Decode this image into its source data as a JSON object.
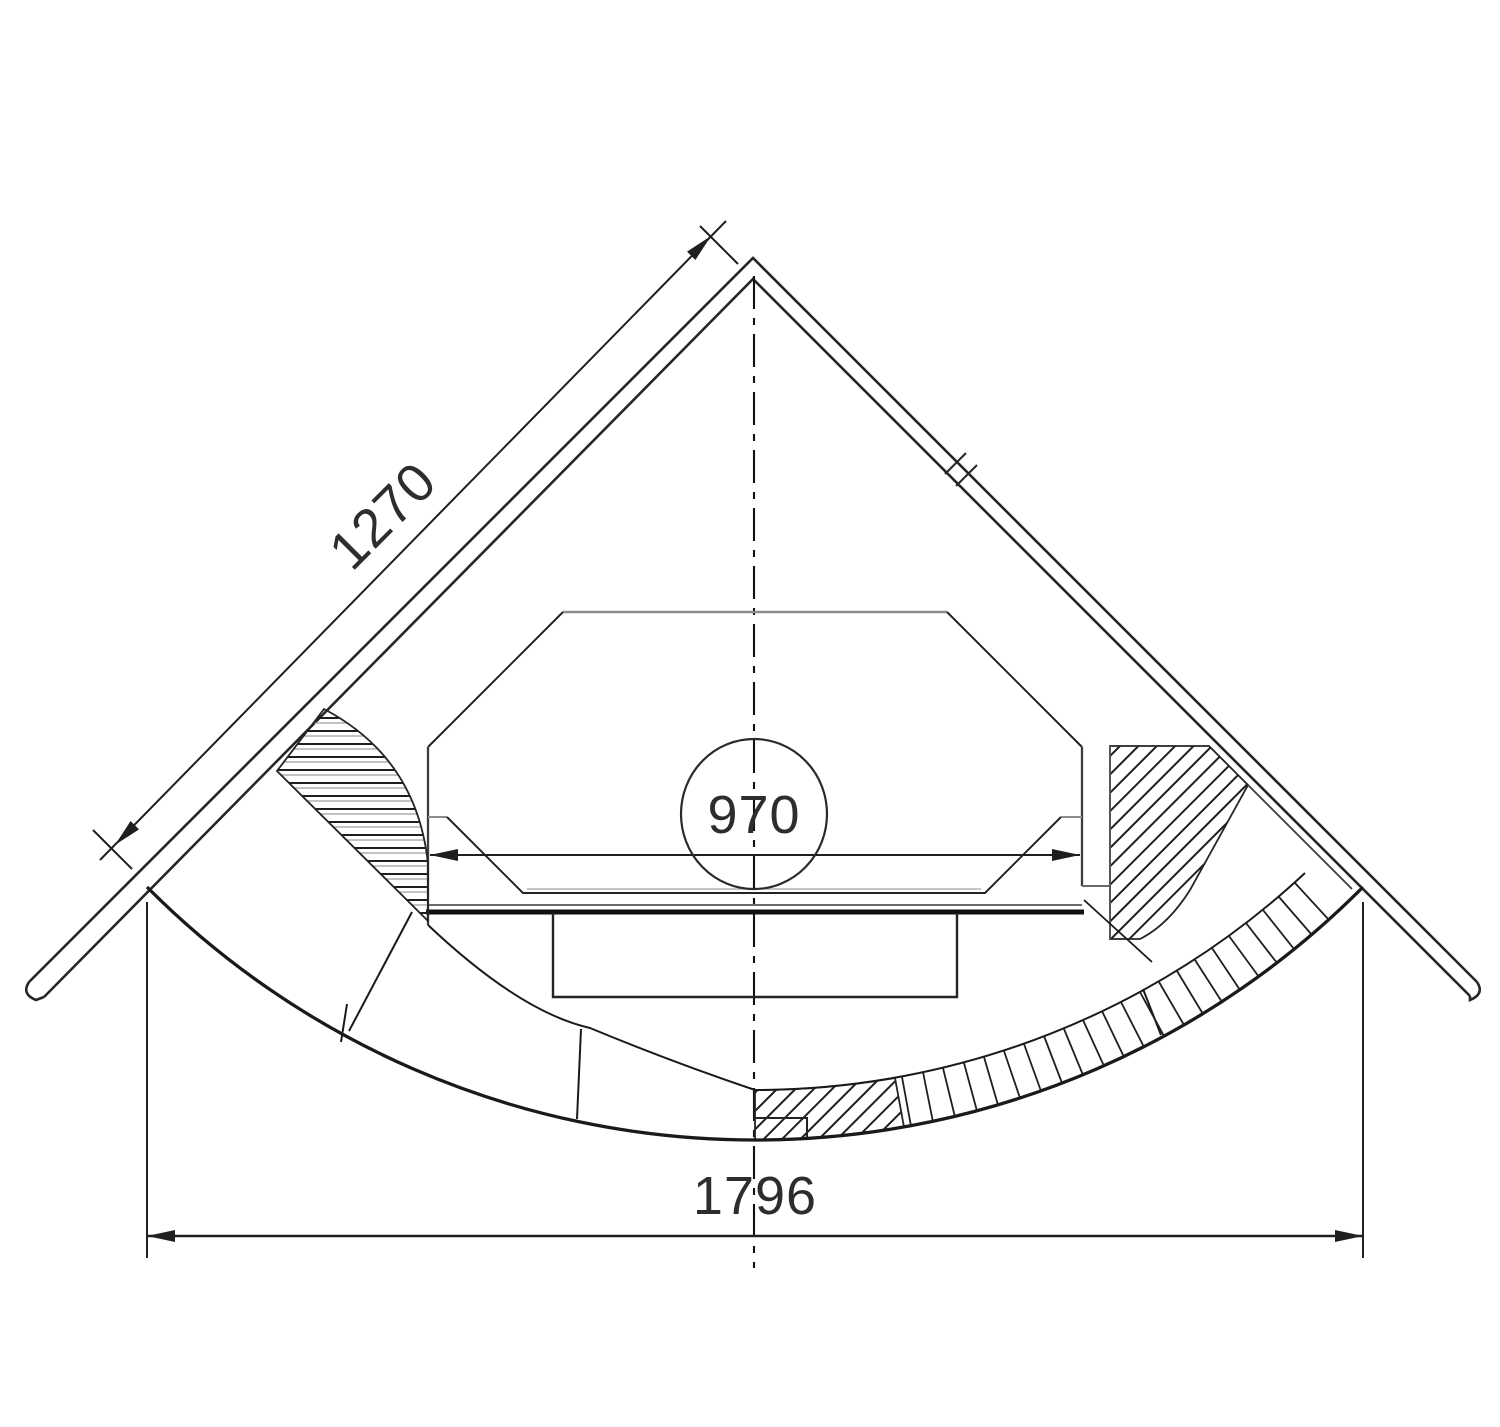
{
  "page": {
    "background": "#ffffff",
    "ink": "#1f1f1f",
    "secondary_line": "#8c8c8c"
  },
  "drawing": {
    "dim_wall_side": "1270",
    "dim_opening_width": "970",
    "dim_front_width": "1796"
  }
}
